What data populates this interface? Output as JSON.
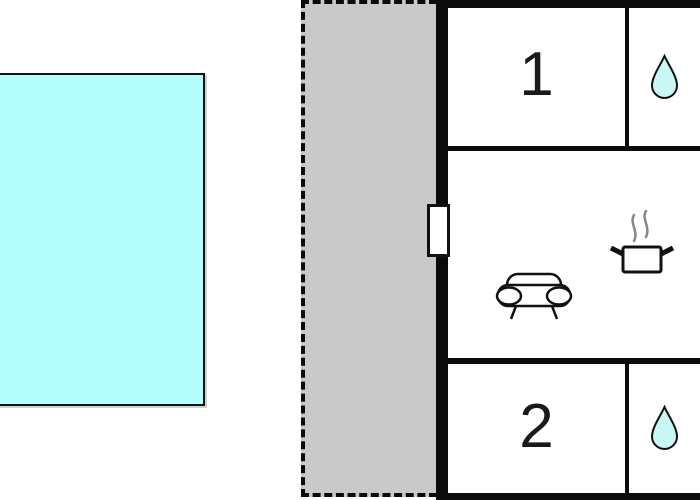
{
  "page": {
    "kind": "holiday-home floor plan",
    "width_px": 700,
    "height_px": 500
  },
  "colors": {
    "pool_fill": "#B4FDFD",
    "terrace_fill": "#C9C9C9",
    "wall": "#0B0B0B",
    "drop_fill": "#C9F7F6",
    "icon_stroke": "#111111",
    "steam": "#878787",
    "label_text": "#1a1a1a"
  },
  "outdoor": {
    "pool": {
      "name": "swimming-pool"
    },
    "terrace": {
      "name": "terrace"
    }
  },
  "rooms": [
    {
      "label": "1",
      "type": "bedroom"
    },
    {
      "label": "2",
      "type": "bedroom"
    }
  ],
  "bathrooms": [
    {
      "icon": "water-drop-icon"
    },
    {
      "icon": "water-drop-icon"
    }
  ],
  "living_area": {
    "icons": [
      "sofa-icon",
      "cooking-pot-icon"
    ],
    "window": "window-on-left-wall"
  }
}
